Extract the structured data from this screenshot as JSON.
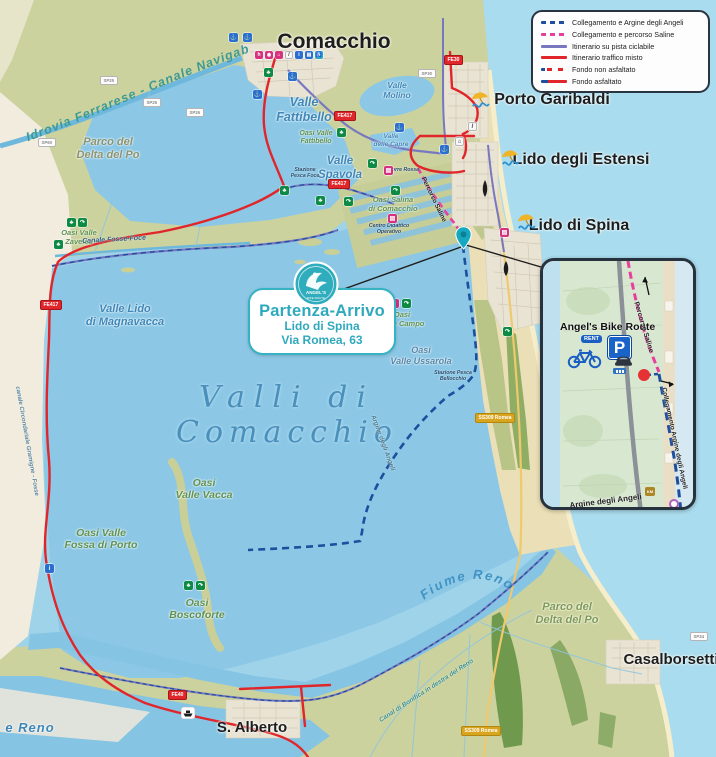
{
  "legend": {
    "items": [
      {
        "label": "Collegamento e  Argine degli Angeli",
        "style": "dash-blue"
      },
      {
        "label": "Collegamento e  percorso Saline",
        "style": "dash-pink"
      },
      {
        "label": "Itinerario su pista ciclabile",
        "style": "solid-purple"
      },
      {
        "label": "Itinerario traffico misto",
        "style": "solid-red"
      },
      {
        "label": "Fondo non asfaltato",
        "style": "dash-bicolor"
      },
      {
        "label": "Fondo asfaltato",
        "style": "solid-bicolor"
      }
    ]
  },
  "places": {
    "comacchio": "Comacchio",
    "porto_garibaldi": "Porto Garibaldi",
    "lido_estensi": "Lido degli Estensi",
    "lido_spina": "Lido di Spina",
    "casalborsetti": "Casalborsetti",
    "s_alberto": "S. Alberto"
  },
  "water_labels": {
    "valli_1": "Valli di",
    "valli_2": "Comacchio",
    "valle_fattibello_1": "Valle",
    "valle_fattibello_2": "Fattibello",
    "valle_spavola_1": "Valle",
    "valle_spavola_2": "Spavola",
    "valle_molino_1": "Valle",
    "valle_molino_2": "Molino",
    "valle_capre_1": "Valle",
    "valle_capre_2": "delle Capre",
    "magnavacca_1": "Valle Lido",
    "magnavacca_2": "di Magnavacca",
    "ussarola_1": "Oasi",
    "ussarola_2": "Valle Ussarola",
    "fiume_reno": "Fiume Reno",
    "e_reno": "e Reno"
  },
  "green_labels": {
    "fattibello_1": "Oasi Valle",
    "fattibello_2": "Fattibello",
    "salina_1": "Oasi Salina",
    "salina_2": "di Comacchio",
    "campo_1": "Oasi",
    "campo_2": "Valle Campo",
    "zavelea_1": "Oasi Valle",
    "zavelea_2": "Zavelea",
    "vacca_1": "Oasi",
    "vacca_2": "Valle Vacca",
    "fossa_1": "Oasi Valle",
    "fossa_2": "Fossa di Porto",
    "boscoforte_1": "Oasi",
    "boscoforte_2": "Boscoforte",
    "parco_nw_1": "Parco del",
    "parco_nw_2": "Delta del Po",
    "parco_se_1": "Parco del",
    "parco_se_2": "Delta del Po"
  },
  "canal_labels": {
    "idrovia": "Idrovia Ferrarese - Canale Navigabile",
    "fosse_foce": "Canale Fosse-Foce",
    "bonifica": "Canal di Bonifica in destra del Reno",
    "circondariale": "canale Circondariale Gramigne - Fosse"
  },
  "route_labels": {
    "percorso_saline": "Percorso Saline",
    "argine_angeli": "Argine degli Angeli"
  },
  "station_labels": {
    "pesca_foce_1": "Stazione",
    "pesca_foce_2": "Pesca Foce",
    "bellocchio_1": "Stazione Pesca",
    "bellocchio_2": "Bellocchio",
    "centro_1": "Centro Didattico",
    "centro_2": "Operativo",
    "torre_rossa": "Torre Rossa"
  },
  "badges": {
    "fe417": "FE417",
    "fe40": "FE40",
    "fe30": "FE30",
    "ss309": "SS309 Romea",
    "sp25": "SP25",
    "sp26": "SP26",
    "sp60": "SP60",
    "sp30": "SP30",
    "sp34": "SP34"
  },
  "callout": {
    "title": "Partenza-Arrivo",
    "line1": "Lido di Spina",
    "line2": "Via Romea, 63",
    "logo_top": "ANGEL'S",
    "logo_bottom": "BIKE ROUTE"
  },
  "inset": {
    "title": "Angel's Bike Route",
    "rent": "RENT",
    "parking_p": "P",
    "percorso_saline": "Percorso Saline",
    "collegamento": "Collegamento Argine degli Angeli",
    "argine": "Argine degli Angeli",
    "km": "KM"
  },
  "icon_glyphs": {
    "anchor": "⚓",
    "tree": "♣",
    "arrow": "↷",
    "hotel": "h",
    "bed": "⌂",
    "museum": "▤",
    "camera": "◉",
    "info": "i",
    "slash": "/",
    "access": "♿"
  },
  "colors": {
    "sea": "#a9dcee",
    "lagoon": "#8cc8e6",
    "land": "#ccd29d",
    "cream": "#f1ecdd",
    "sand": "#eadfb6",
    "red_route": "#e0262a",
    "purple_route": "#7878c0",
    "pink_route": "#e83e9e",
    "navy_route": "#1d4f9e",
    "teal_accent": "#2fadbc",
    "legend_border": "#2b3542"
  }
}
